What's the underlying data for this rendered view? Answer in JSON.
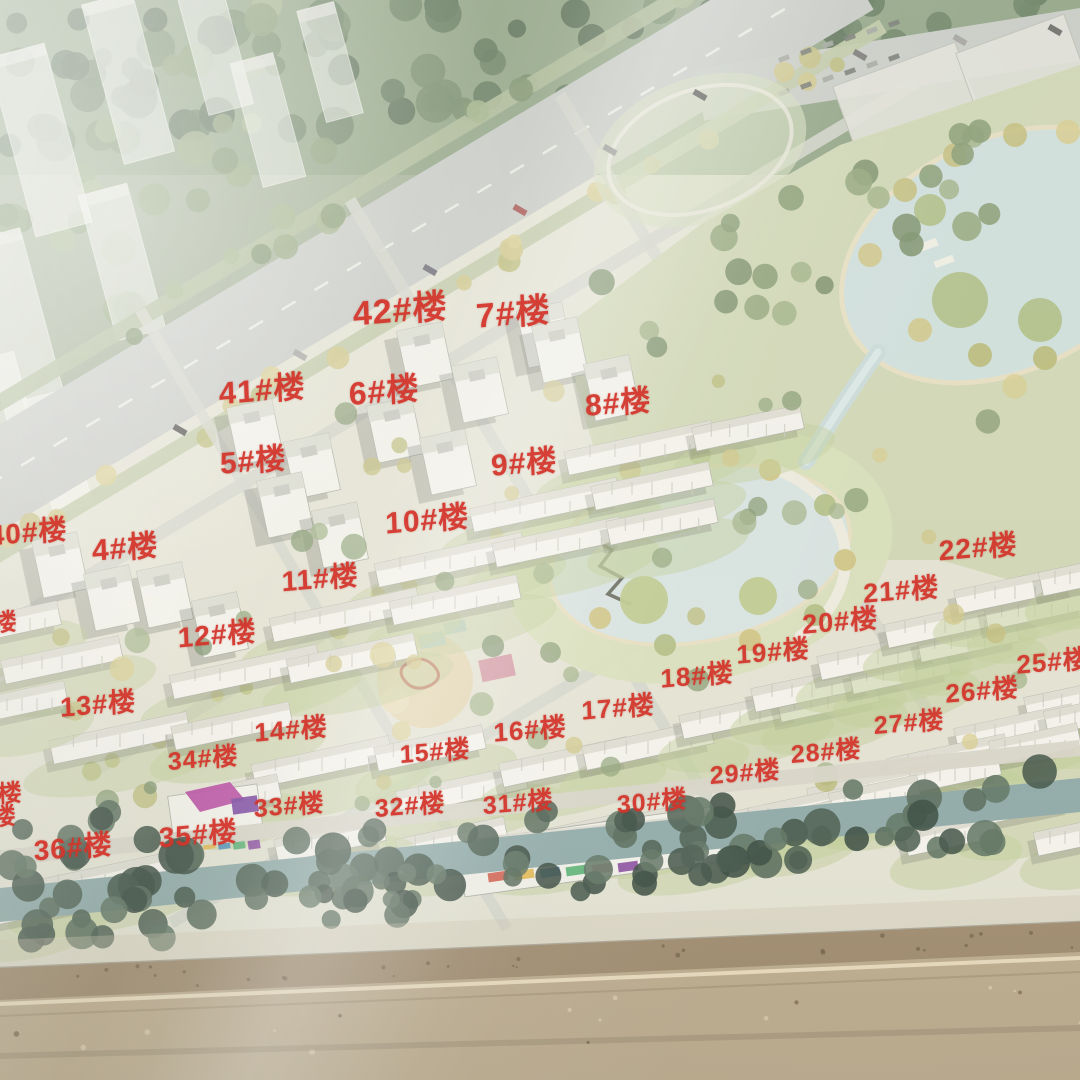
{
  "photo": {
    "description": "Photograph of a glossy site-plan billboard showing an aerial rendering of a residential development: diagonal boulevard and ghosted city blocks at upper left, forest band and commercial lots at top, numbered apartment rows through the middle, a large curved lake park on the right, a tree-lined river along the bottom, and real dirt ground in front of the board at the very bottom. Red Chinese labels mark each building number.",
    "label_color": "#d4352b"
  },
  "building_labels": [
    {
      "text": "42#楼",
      "x": 37.0,
      "y": 28.4,
      "size": 34
    },
    {
      "text": "7#楼",
      "x": 47.5,
      "y": 28.7,
      "size": 34
    },
    {
      "text": "41#楼",
      "x": 24.3,
      "y": 35.8,
      "size": 31
    },
    {
      "text": "6#楼",
      "x": 35.6,
      "y": 36.0,
      "size": 32
    },
    {
      "text": "8#楼",
      "x": 57.2,
      "y": 37.0,
      "size": 30
    },
    {
      "text": "5#楼",
      "x": 23.4,
      "y": 42.4,
      "size": 30
    },
    {
      "text": "9#楼",
      "x": 48.5,
      "y": 42.6,
      "size": 30
    },
    {
      "text": "40#楼",
      "x": 2.6,
      "y": 49.2,
      "size": 28
    },
    {
      "text": "4#楼",
      "x": 11.6,
      "y": 50.5,
      "size": 30
    },
    {
      "text": "10#楼",
      "x": 39.5,
      "y": 47.9,
      "size": 30
    },
    {
      "text": "11#楼",
      "x": 29.6,
      "y": 53.4,
      "size": 28
    },
    {
      "text": "22#楼",
      "x": 90.6,
      "y": 50.6,
      "size": 28
    },
    {
      "text": "21#楼",
      "x": 83.4,
      "y": 54.4,
      "size": 27
    },
    {
      "text": "20#楼",
      "x": 77.8,
      "y": 57.3,
      "size": 27
    },
    {
      "text": "12#楼",
      "x": 20.1,
      "y": 58.6,
      "size": 28
    },
    {
      "text": "19#楼",
      "x": 71.6,
      "y": 60.2,
      "size": 26
    },
    {
      "text": "25#楼",
      "x": 97.5,
      "y": 61.1,
      "size": 26
    },
    {
      "text": "18#楼",
      "x": 64.5,
      "y": 62.4,
      "size": 26
    },
    {
      "text": "26#楼",
      "x": 90.9,
      "y": 63.8,
      "size": 26
    },
    {
      "text": "13#楼",
      "x": 9.1,
      "y": 65.0,
      "size": 27
    },
    {
      "text": "17#楼",
      "x": 57.2,
      "y": 65.4,
      "size": 26
    },
    {
      "text": "27#楼",
      "x": 84.2,
      "y": 66.8,
      "size": 25
    },
    {
      "text": "14#楼",
      "x": 26.9,
      "y": 67.4,
      "size": 26
    },
    {
      "text": "16#楼",
      "x": 49.1,
      "y": 67.4,
      "size": 26
    },
    {
      "text": "34#楼",
      "x": 18.8,
      "y": 70.1,
      "size": 25
    },
    {
      "text": "15#楼",
      "x": 40.3,
      "y": 69.4,
      "size": 25
    },
    {
      "text": "28#楼",
      "x": 76.5,
      "y": 69.4,
      "size": 25
    },
    {
      "text": "29#楼",
      "x": 69.0,
      "y": 71.4,
      "size": 25
    },
    {
      "text": "33#楼",
      "x": 26.8,
      "y": 74.4,
      "size": 25
    },
    {
      "text": "32#楼",
      "x": 38.0,
      "y": 74.4,
      "size": 25
    },
    {
      "text": "31#楼",
      "x": 48.0,
      "y": 74.2,
      "size": 25
    },
    {
      "text": "30#楼",
      "x": 60.4,
      "y": 74.1,
      "size": 25
    },
    {
      "text": "35#楼",
      "x": 18.3,
      "y": 77.1,
      "size": 28
    },
    {
      "text": "36#楼",
      "x": 6.8,
      "y": 78.3,
      "size": 28
    }
  ],
  "edge_partial_labels": [
    {
      "text": "楼",
      "x": 0.5,
      "y": 57.4,
      "size": 24
    },
    {
      "text": "楼",
      "x": 0.9,
      "y": 73.2,
      "size": 24
    },
    {
      "text": "楼",
      "x": 0.4,
      "y": 75.4,
      "size": 24
    }
  ]
}
